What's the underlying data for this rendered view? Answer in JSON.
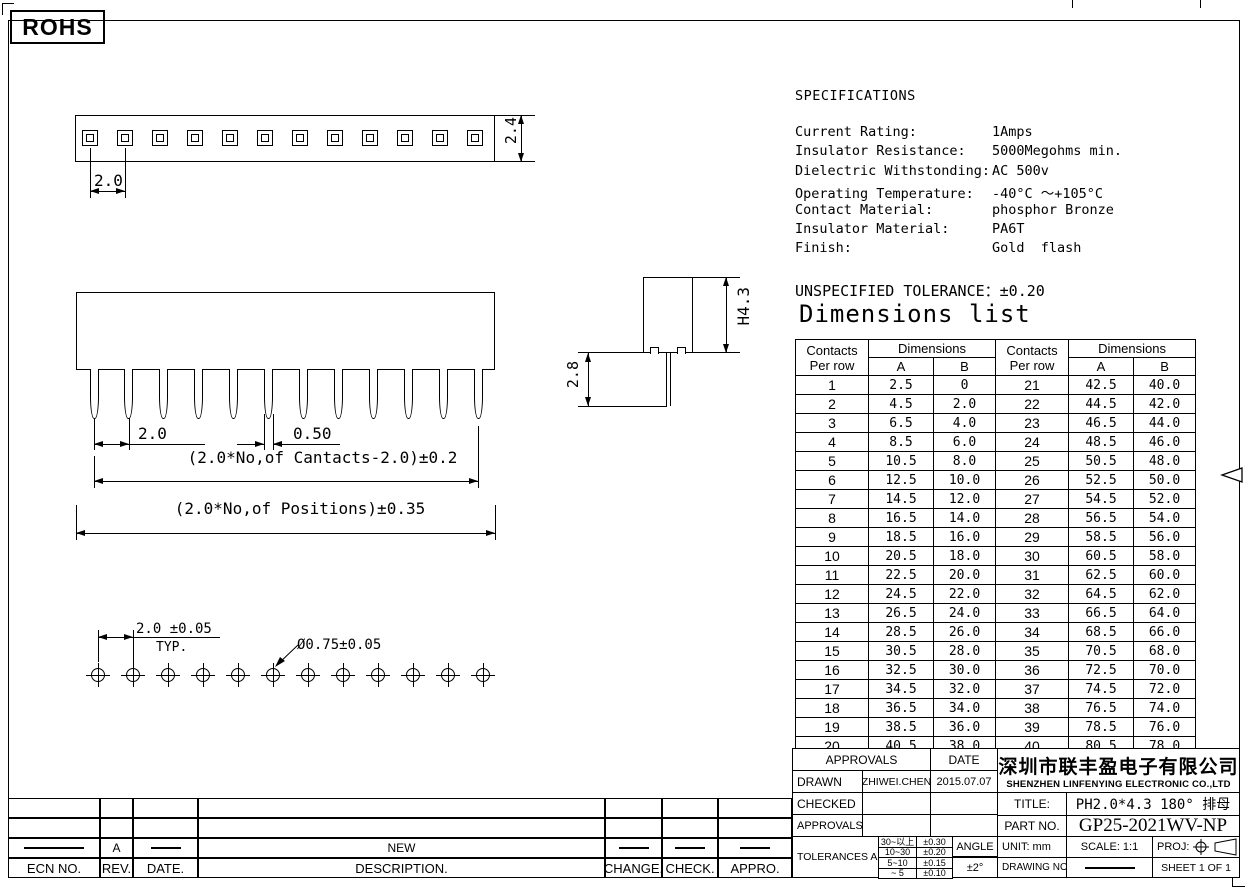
{
  "badge": {
    "rohs": "ROHS"
  },
  "specs": {
    "heading": "SPECIFICATIONS",
    "rows": [
      {
        "label": "Current Rating:",
        "value": "1Amps"
      },
      {
        "label": "Insulator Resistance:",
        "value": "5000Megohms min."
      },
      {
        "label": "Dielectric Withstonding:",
        "value": "AC 500v"
      },
      {
        "label": "Operating Temperature:",
        "value": "-40°C ～+105°C"
      },
      {
        "label": "Contact Material:",
        "value": "phosphor Bronze"
      },
      {
        "label": "Insulator Material:",
        "value": "PA6T"
      },
      {
        "label": "Finish:",
        "value": "Gold  flash"
      }
    ]
  },
  "tolerance_note": "UNSPECIFIED TOLERANCE：±0.20",
  "dimensions_list": {
    "title": "Dimensions list",
    "col_headers": {
      "contacts": "Contacts",
      "per_row": "Per row",
      "dimensions": "Dimensions",
      "a": "A",
      "b": "B"
    },
    "left_rows": [
      [
        "1",
        "2.5",
        "0"
      ],
      [
        "2",
        "4.5",
        "2.0"
      ],
      [
        "3",
        "6.5",
        "4.0"
      ],
      [
        "4",
        "8.5",
        "6.0"
      ],
      [
        "5",
        "10.5",
        "8.0"
      ],
      [
        "6",
        "12.5",
        "10.0"
      ],
      [
        "7",
        "14.5",
        "12.0"
      ],
      [
        "8",
        "16.5",
        "14.0"
      ],
      [
        "9",
        "18.5",
        "16.0"
      ],
      [
        "10",
        "20.5",
        "18.0"
      ],
      [
        "11",
        "22.5",
        "20.0"
      ],
      [
        "12",
        "24.5",
        "22.0"
      ],
      [
        "13",
        "26.5",
        "24.0"
      ],
      [
        "14",
        "28.5",
        "26.0"
      ],
      [
        "15",
        "30.5",
        "28.0"
      ],
      [
        "16",
        "32.5",
        "30.0"
      ],
      [
        "17",
        "34.5",
        "32.0"
      ],
      [
        "18",
        "36.5",
        "34.0"
      ],
      [
        "19",
        "38.5",
        "36.0"
      ],
      [
        "20",
        "40.5",
        "38.0"
      ]
    ],
    "right_rows": [
      [
        "21",
        "42.5",
        "40.0"
      ],
      [
        "22",
        "44.5",
        "42.0"
      ],
      [
        "23",
        "46.5",
        "44.0"
      ],
      [
        "24",
        "48.5",
        "46.0"
      ],
      [
        "25",
        "50.5",
        "48.0"
      ],
      [
        "26",
        "52.5",
        "50.0"
      ],
      [
        "27",
        "54.5",
        "52.0"
      ],
      [
        "28",
        "56.5",
        "54.0"
      ],
      [
        "29",
        "58.5",
        "56.0"
      ],
      [
        "30",
        "60.5",
        "58.0"
      ],
      [
        "31",
        "62.5",
        "60.0"
      ],
      [
        "32",
        "64.5",
        "62.0"
      ],
      [
        "33",
        "66.5",
        "64.0"
      ],
      [
        "34",
        "68.5",
        "66.0"
      ],
      [
        "35",
        "70.5",
        "68.0"
      ],
      [
        "36",
        "72.5",
        "70.0"
      ],
      [
        "37",
        "74.5",
        "72.0"
      ],
      [
        "38",
        "76.5",
        "74.0"
      ],
      [
        "39",
        "78.5",
        "76.0"
      ],
      [
        "40",
        "80.5",
        "78.0"
      ]
    ]
  },
  "drawings": {
    "top_view": {
      "pin_count": 12,
      "pitch_label": "2.0",
      "height_label": "2.4"
    },
    "front_view": {
      "pin_count": 12,
      "pitch_label": "2.0",
      "pin_width_label": "0.50",
      "formula_contacts": "(2.0*No,of Cantacts-2.0)±0.2",
      "formula_positions": "(2.0*No,of Positions)±0.35"
    },
    "side_view": {
      "height_label": "H4.3",
      "pin_length_label": "2.8"
    },
    "footprint": {
      "hole_count": 12,
      "pitch_label": "2.0 ±0.05",
      "typ_label": "TYP.",
      "hole_label": "Ø0.75±0.05"
    }
  },
  "title_block": {
    "approvals_header": "APPROVALS",
    "date_header": "DATE",
    "drawn_label": "DRAWN",
    "drawn_by": "ZHIWEI.CHEN",
    "drawn_date": "2015.07.07",
    "checked_label": "CHECKED",
    "approvals_label": "APPROVALS",
    "tolerances_label": "TOLERANCES  ARE",
    "tolerance_rows": [
      [
        "30~以上",
        "±0.30"
      ],
      [
        "10~30",
        "±0.20"
      ],
      [
        "5~10",
        "±0.15"
      ],
      [
        "~ 5",
        "±0.10"
      ]
    ],
    "angle_label": "ANGLE",
    "angle_value": "±2°",
    "company_cn": "深圳市联丰盈电子有限公司",
    "company_en": "SHENZHEN LINFENYING ELECTRONIC CO.,LTD",
    "title_label": "TITLE:",
    "title_value": "PH2.0*4.3 180° 排母",
    "part_label": "PART NO.",
    "part_value": "GP25-2021WV-NP",
    "unit_label": "UNIT: mm",
    "scale_label": "SCALE: 1:1",
    "proj_label": "PROJ:",
    "drawing_no_label": "DRAWING NO.",
    "sheet_label": "SHEET  1 OF 1"
  },
  "revision_table": {
    "headers": [
      "ECN NO.",
      "REV.",
      "DATE.",
      "DESCRIPTION.",
      "CHANGE.",
      "CHECK.",
      "APPRO."
    ],
    "row": {
      "rev": "A",
      "description": "NEW"
    }
  }
}
